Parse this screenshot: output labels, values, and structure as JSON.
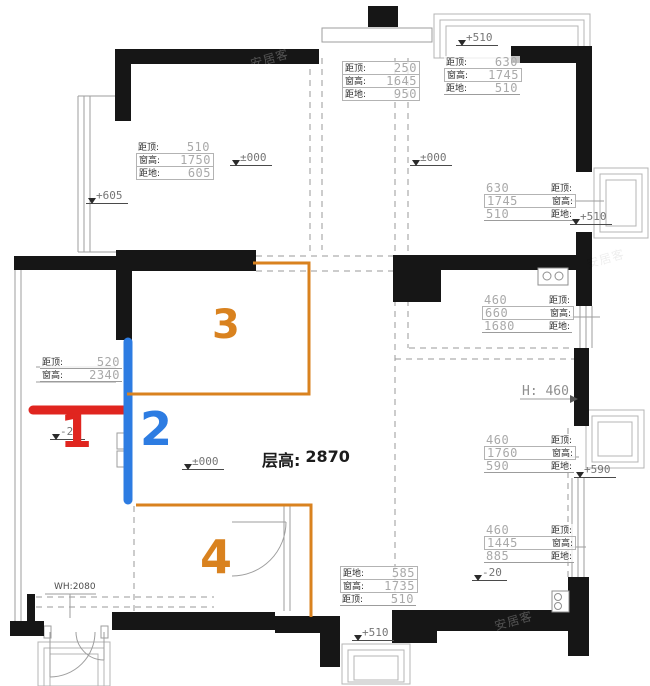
{
  "colors": {
    "red": "#e0251f",
    "blue": "#2d7ce2",
    "orange": "#d9821f",
    "wall": "#161616",
    "line": "#9e9e9e",
    "dim_value": "#a9a9a9",
    "dim_label": "#2f2f2f"
  },
  "watermark": {
    "text": "安居客"
  },
  "floor_height": {
    "label": "层高:",
    "value": "2870"
  },
  "h_label": {
    "value": "H: 460"
  },
  "door_label": {
    "value": "WH:2080"
  },
  "zones": [
    {
      "number": "1"
    },
    {
      "number": "2"
    },
    {
      "number": "3"
    },
    {
      "number": "4"
    }
  ],
  "markers": {
    "top_left_room": "±000",
    "left_upper": "+605",
    "top_right_bay": "+510",
    "top_right_room": "±000",
    "east_mid": "+510",
    "center": "±000",
    "east_lower": "+590",
    "west_neg": "-20",
    "south_east_neg": "-20",
    "south_bay": "+510"
  },
  "dims": {
    "top_left": {
      "rows": [
        {
          "label": "距顶:",
          "value": "510"
        },
        {
          "label": "窗高:",
          "value": "1750"
        },
        {
          "label": "距地:",
          "value": "605"
        }
      ]
    },
    "top_middle": {
      "rows": [
        {
          "label": "距顶:",
          "value": "250"
        },
        {
          "label": "窗高:",
          "value": "1645"
        },
        {
          "label": "距地:",
          "value": "950"
        }
      ]
    },
    "top_right": {
      "rows": [
        {
          "label": "距顶:",
          "value": "630"
        },
        {
          "label": "窗高:",
          "value": "1745"
        },
        {
          "label": "距地:",
          "value": "510"
        }
      ]
    },
    "east_upper": {
      "rows": [
        {
          "value": "630",
          "label": "距顶:"
        },
        {
          "value": "1745",
          "label": "窗高:"
        },
        {
          "value": "510",
          "label": "距地:"
        }
      ]
    },
    "east_r1": {
      "rows": [
        {
          "value": "460",
          "label": "距顶:"
        },
        {
          "value": "660",
          "label": "窗高:"
        },
        {
          "value": "1680",
          "label": "距地:"
        }
      ]
    },
    "east_r2": {
      "rows": [
        {
          "value": "460",
          "label": "距顶:"
        },
        {
          "value": "1760",
          "label": "窗高:"
        },
        {
          "value": "590",
          "label": "距地:"
        }
      ]
    },
    "east_r3": {
      "rows": [
        {
          "value": "460",
          "label": "距顶:"
        },
        {
          "value": "1445",
          "label": "窗高:"
        },
        {
          "value": "885",
          "label": "距地:"
        }
      ]
    },
    "south_middle": {
      "rows": [
        {
          "label": "距地:",
          "value": "585"
        },
        {
          "label": "窗高:",
          "value": "1735"
        },
        {
          "label": "距顶:",
          "value": "510"
        }
      ]
    },
    "west": {
      "rows": [
        {
          "label": "距顶:",
          "value": "520"
        },
        {
          "label": "窗高:",
          "value": "2340"
        }
      ]
    }
  }
}
